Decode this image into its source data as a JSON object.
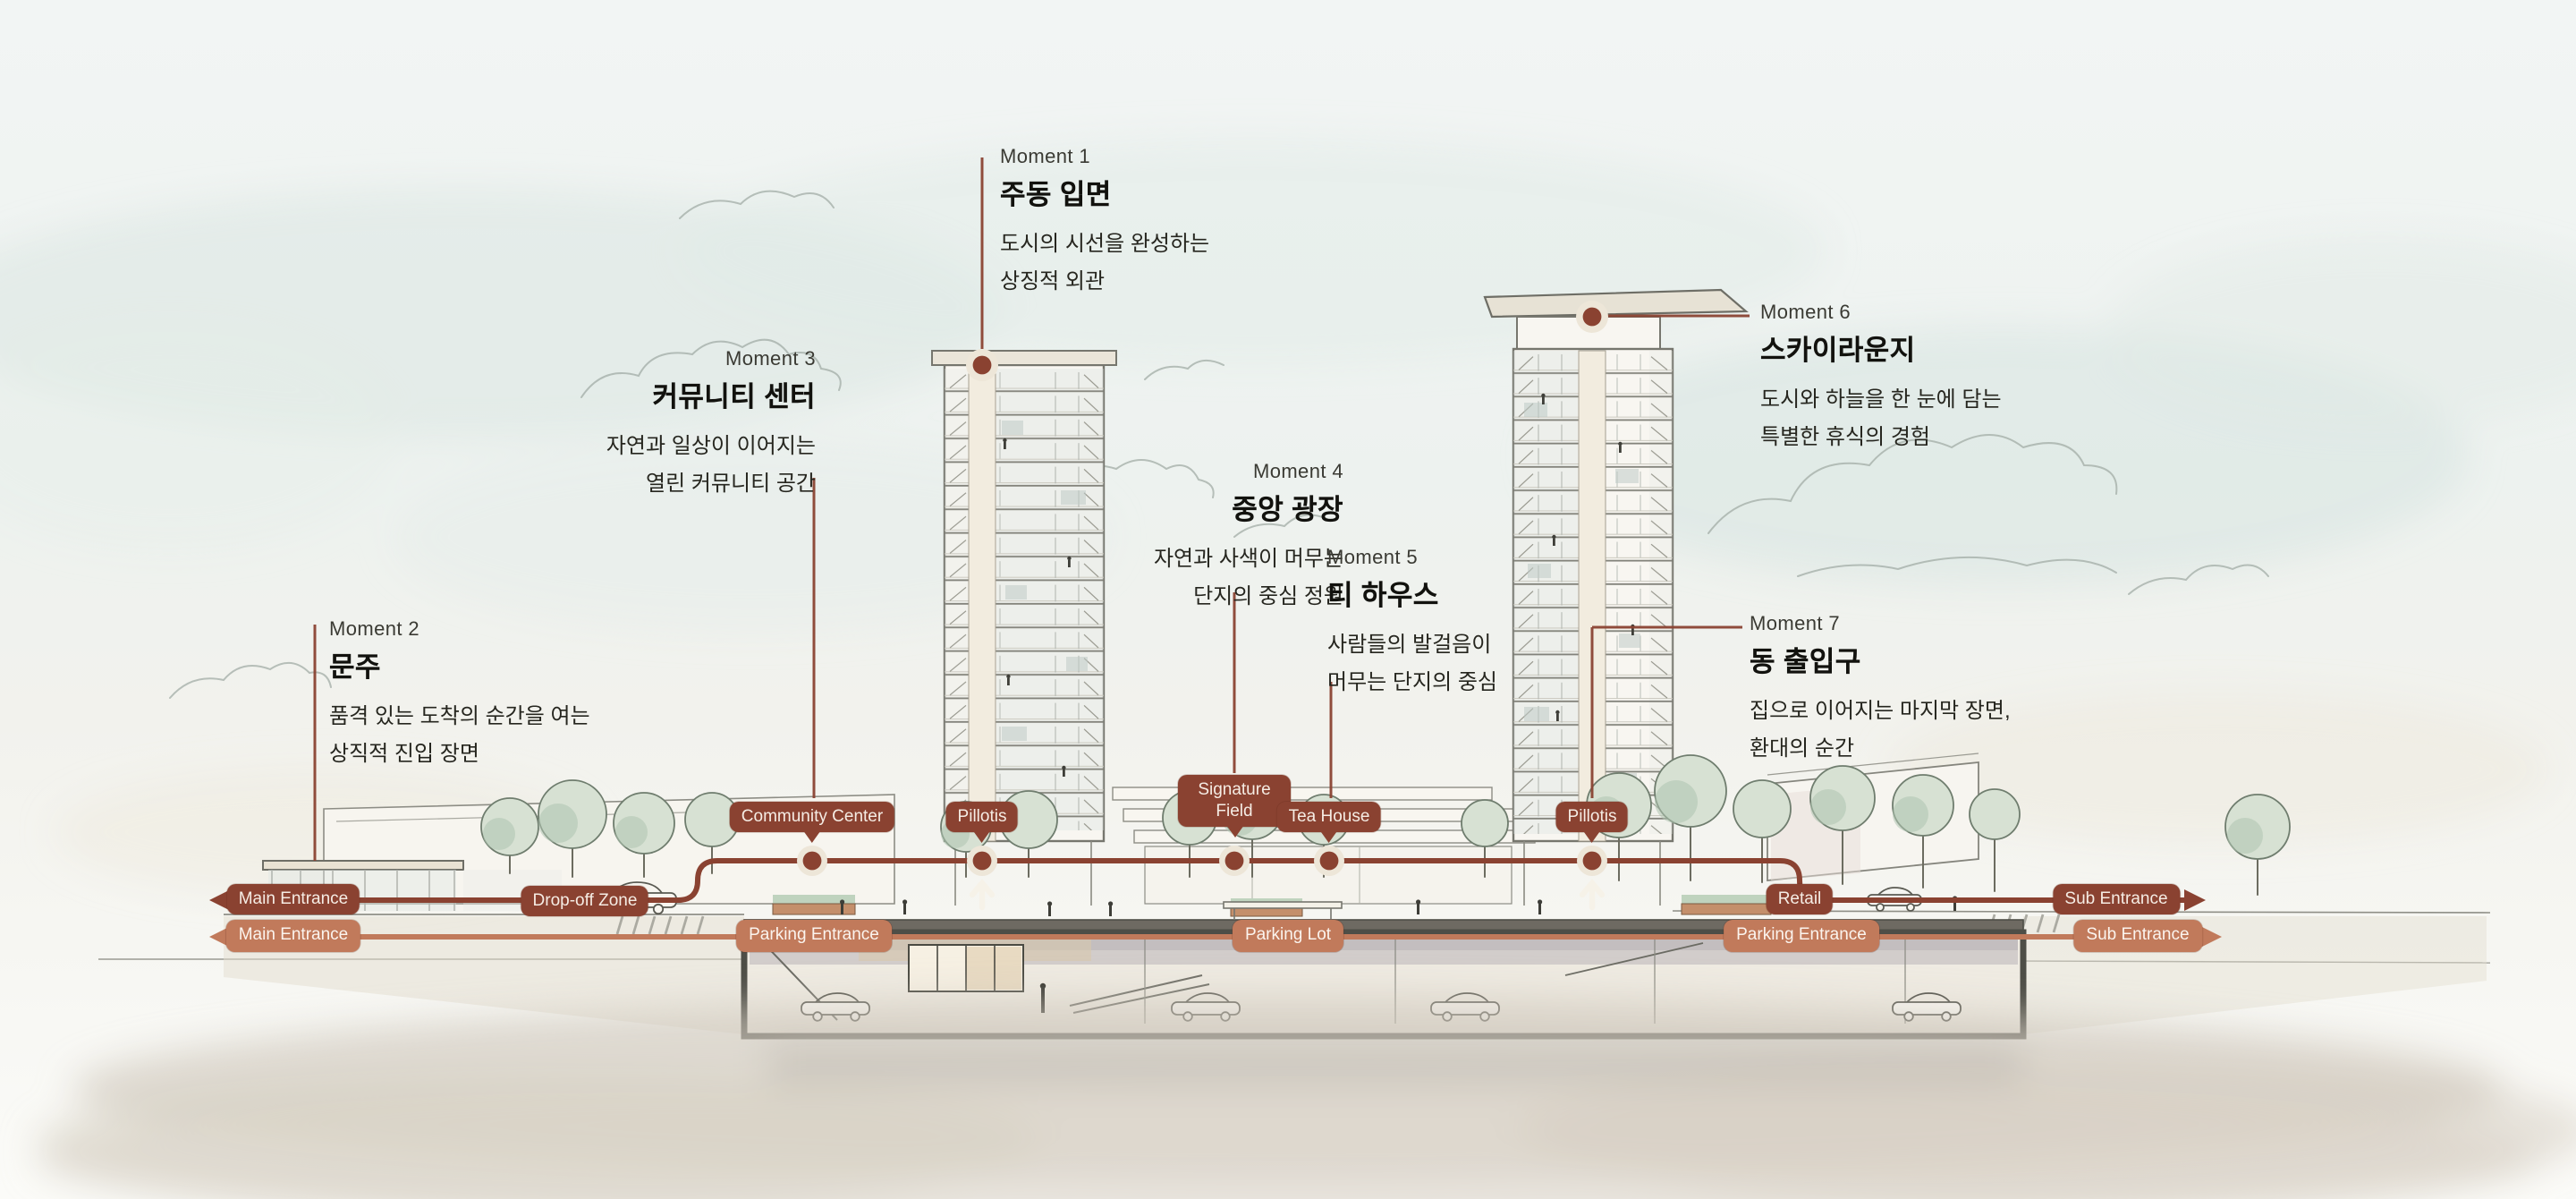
{
  "moments": [
    {
      "label": "Moment 1",
      "title": "주동 입면",
      "desc1": "도시의 시선을 완성하는",
      "desc2": "상징적 외관"
    },
    {
      "label": "Moment 2",
      "title": "문주",
      "desc1": "품격 있는 도착의 순간을 여는",
      "desc2": "상직적 진입 장면"
    },
    {
      "label": "Moment 3",
      "title": "커뮤니티 센터",
      "desc1": "자연과 일상이 이어지는",
      "desc2": "열린 커뮤니티 공간"
    },
    {
      "label": "Moment 4",
      "title": "중앙 광장",
      "desc1": "자연과 사색이 머무는",
      "desc2": "단지의 중심 정원"
    },
    {
      "label": "Moment 5",
      "title": "티 하우스",
      "desc1": "사람들의 발걸음이",
      "desc2": "머무는 단지의 중심"
    },
    {
      "label": "Moment 6",
      "title": "스카이라운지",
      "desc1": "도시와 하늘을 한 눈에 담는",
      "desc2": "특별한 휴식의 경험"
    },
    {
      "label": "Moment 7",
      "title": "동 출입구",
      "desc1": "집으로 이어지는 마지막 장면,",
      "desc2": "환대의 순간"
    }
  ],
  "badges": {
    "community_center": "Community Center",
    "pillotis_left": "Pillotis",
    "signature_field": "Signature Field",
    "tea_house": "Tea House",
    "pillotis_right": "Pillotis",
    "main_entrance_upper": "Main Entrance",
    "dropoff_zone": "Drop-off Zone",
    "retail": "Retail",
    "sub_entrance_upper": "Sub Entrance",
    "main_entrance_lower": "Main Entrance",
    "parking_entrance_left": "Parking Entrance",
    "parking_lot": "Parking Lot",
    "parking_entrance_right": "Parking Entrance",
    "sub_entrance_lower": "Sub Entrance"
  },
  "colors": {
    "brick": "#8A4231",
    "salmon": "#C17A5B",
    "halo": "#EDE6D8",
    "ink": "#26261F"
  }
}
